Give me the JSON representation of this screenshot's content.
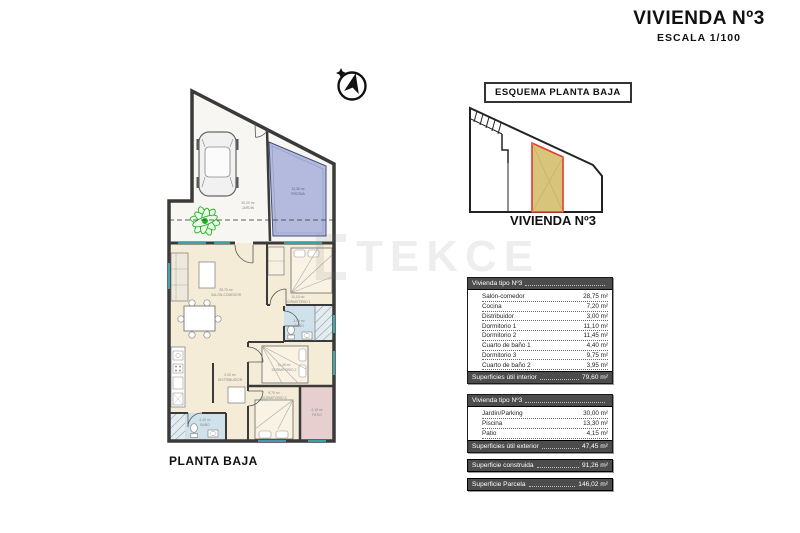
{
  "page": {
    "title": "VIVIENDA Nº3",
    "subtitle": "ESCALA 1/100",
    "watermark": "TEKCE"
  },
  "floor_plan": {
    "caption": "PLANTA BAJA",
    "labels": {
      "jardin": {
        "area": "30,00 m²",
        "name": "JARDIN"
      },
      "piscina": {
        "area": "13,30 m²",
        "name": "PISCINA"
      },
      "salon": {
        "area": "28,75 m²",
        "name": "SALÓN-COMEDOR"
      },
      "dormitorio1": {
        "area": "11,10 m²",
        "name": "DORMITORIO 1"
      },
      "bano1": {
        "area": "3,95 m²",
        "name": "BAÑO"
      },
      "dormitorio2": {
        "area": "11,45 m²",
        "name": "DORMITORIO 2"
      },
      "distribuidor": {
        "area": "3,00 m²",
        "name": "DISTRIBUIDOR"
      },
      "dormitorio3": {
        "area": "9,75 m²",
        "name": "DORMITORIO 3"
      },
      "bano2": {
        "area": "4,40 m²",
        "name": "BAÑO"
      },
      "patio": {
        "area": "4,15 m²",
        "name": "PATIO"
      }
    }
  },
  "esquema": {
    "box_label": "ESQUEMA PLANTA BAJA",
    "caption": "VIVIENDA Nº3"
  },
  "tables": {
    "interior": {
      "header": "Vivienda tipo Nº3",
      "rows": [
        {
          "label": "Salón-comedor",
          "value": "28,75 m²"
        },
        {
          "label": "Cocina",
          "value": "7,20 m²"
        },
        {
          "label": "Distribuidor",
          "value": "3,00 m²"
        },
        {
          "label": "Dormitorio 1",
          "value": "11,10 m²"
        },
        {
          "label": "Dormitorio 2",
          "value": "11,45 m²"
        },
        {
          "label": "Cuarto de baño 1",
          "value": "4,40 m²"
        },
        {
          "label": "Dormitorio 3",
          "value": "9,75 m²"
        },
        {
          "label": "Cuarto de baño 2",
          "value": "3,95 m²"
        }
      ],
      "footer": {
        "label": "Superficies útil interior",
        "value": "79,60 m²"
      }
    },
    "exterior": {
      "header": "Vivienda tipo Nº3",
      "rows": [
        {
          "label": "Jardín/Parking",
          "value": "30,00 m²"
        },
        {
          "label": "Piscina",
          "value": "13,30 m²"
        },
        {
          "label": "Patio",
          "value": "4,15 m²"
        }
      ],
      "footer": {
        "label": "Superficies útil exterior",
        "value": "47,45 m²"
      }
    },
    "construida": {
      "label": "Superficie construida",
      "value": "91,26 m²"
    },
    "parcela": {
      "label": "Superficie Parcela",
      "value": "146,02 m²"
    }
  },
  "colors": {
    "highlight_fill": "#d9c47c",
    "highlight_stroke": "#e8392b",
    "pool": "#b3bade",
    "interior_floor": "#f4ecd7",
    "bathroom": "#cfe2ec",
    "patio": "#e7cfcf",
    "bar_background": "#4c4c4c",
    "plant_green": "#21b021",
    "window_cyan": "#3fc1c9"
  }
}
